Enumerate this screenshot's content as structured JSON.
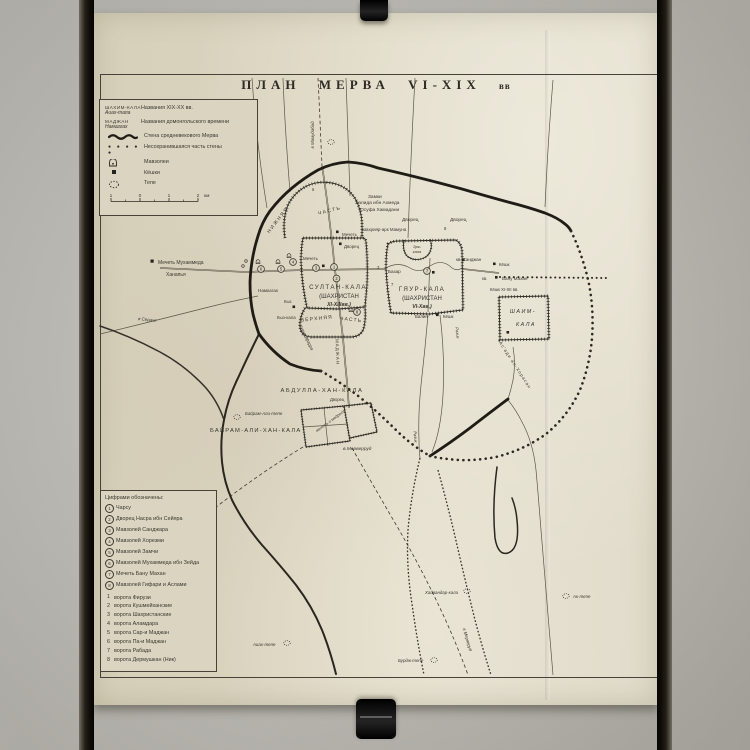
{
  "title": {
    "main": "ПЛАН  МЕРВА  VI-XIX",
    "suffix": "вв"
  },
  "colors": {
    "paper": "#dbd5c1",
    "ink": "#2c2922",
    "frame": "#0e0b07",
    "photo_bg": "#c6c4be"
  },
  "legend": {
    "new_name_example_1": "ШАХИМ-КАЛА",
    "new_name_example_2": "Аиах-тапа",
    "new_name_desc": "Названия XIX-XX вв.",
    "old_name_example_1": "МАДЖАН",
    "old_name_example_2": "Намазгах",
    "old_name_desc": "Названия домонгольского времени",
    "wall_desc": "Стена средневекового Мерва",
    "wall_lost_desc": "Несохранившаяся часть стены",
    "mausoleum_desc": "Мавзолеи",
    "koshk_desc": "Кёшки",
    "tepe_desc": "Тепе",
    "dots_symbol": "● ● ● ● ●",
    "scale": {
      "ticks": [
        "1",
        "0",
        "1",
        "2"
      ],
      "unit": "км"
    }
  },
  "numbered_legend": {
    "heading": "Цифрами обозначены:",
    "sites": [
      {
        "n": "1",
        "label": "Чарсу"
      },
      {
        "n": "2",
        "label": "Дворец Насра ибн Сейяра"
      },
      {
        "n": "3",
        "label": "Мавзолей Санджара"
      },
      {
        "n": "4",
        "label": "Мавзолей Хорезми"
      },
      {
        "n": "5",
        "label": "Мавзолей Замчи"
      },
      {
        "n": "6",
        "label": "Мавзолей Мухаммеда ибн Зейда"
      },
      {
        "n": "7",
        "label": "Мечеть Бану Махан"
      },
      {
        "n": "8",
        "label": "Мавзолей Гифари и Аслами"
      }
    ],
    "gates": [
      {
        "n": "1",
        "label": "ворота Фирузи"
      },
      {
        "n": "2",
        "label": "ворота Кушмейханские"
      },
      {
        "n": "3",
        "label": "ворота Шахристанские"
      },
      {
        "n": "4",
        "label": "ворота Аламдара"
      },
      {
        "n": "5",
        "label": "ворота Сар-и Маджан"
      },
      {
        "n": "6",
        "label": "ворота Па-и Маджан"
      },
      {
        "n": "7",
        "label": "ворота Рабада"
      },
      {
        "n": "8",
        "label": "ворота Дермушкан (Ник)"
      }
    ]
  },
  "map": {
    "sites": [
      {
        "n": "1"
      },
      {
        "n": "2"
      },
      {
        "n": "3"
      },
      {
        "n": "4"
      },
      {
        "n": "5"
      },
      {
        "n": "6"
      },
      {
        "n": "7"
      },
      {
        "n": "8"
      }
    ],
    "gate_digits": [
      {
        "n": "6"
      },
      {
        "n": "3"
      },
      {
        "n": "8"
      },
      {
        "n": "7"
      }
    ],
    "labels": [
      {
        "t": "Замки"
      },
      {
        "t": "Халида ибн Ахмеда"
      },
      {
        "t": "Юсуфа Хамадани"
      },
      {
        "t": "Дворец"
      },
      {
        "t": "Шахрияр-арк Мамуна"
      },
      {
        "t": "Мечеть"
      },
      {
        "t": "Дворец"
      },
      {
        "t": "Дворец"
      },
      {
        "t": "НИЖНЯЯ"
      },
      {
        "t": "ЧАСТЬ"
      },
      {
        "t": "Мечеть"
      },
      {
        "t": "СУЛТАН-КАЛА"
      },
      {
        "t": "(ШАХРИСТАН"
      },
      {
        "t": "XI-XIIIвв.)"
      },
      {
        "t": "ВЕРХНЯЯ"
      },
      {
        "t": "ЧАСТЬ"
      },
      {
        "t": "ГЯУР-КАЛА"
      },
      {
        "t": "(ШАХРИСТАН"
      },
      {
        "t": "VI-Xвв.)"
      },
      {
        "t": "Эрк-"
      },
      {
        "t": "кала"
      },
      {
        "t": "Базар"
      },
      {
        "t": "кв. Санджан"
      },
      {
        "t": "Кёшк"
      },
      {
        "t": "кв."
      },
      {
        "t": "Бану Махан"
      },
      {
        "t": "Кёшк XI-XII вв."
      },
      {
        "t": "ШАИМ-"
      },
      {
        "t": "КАЛА"
      },
      {
        "t": "Балин"
      },
      {
        "t": "Кёшк"
      },
      {
        "t": "Мечеть Мухаммеда"
      },
      {
        "t": "Ханапья"
      },
      {
        "t": "в Серахс"
      },
      {
        "t": "Намазгах"
      },
      {
        "t": "Кыз"
      },
      {
        "t": "Кыз-кала"
      },
      {
        "t": "Хурмузфарра"
      },
      {
        "t": "МАДЖАН"
      },
      {
        "t": "Разик"
      },
      {
        "t": "Разик"
      },
      {
        "t": "Ас'ади ал-Хорасан"
      },
      {
        "t": "АБДУЛЛА-ХАН-КАЛА"
      },
      {
        "t": "Дворец"
      },
      {
        "t": "мечеть и медресе"
      },
      {
        "t": "Байрам-Али-тепе"
      },
      {
        "t": "БАЙРАМ-АЛИ-ХАН-КАЛА"
      },
      {
        "t": "в.Мерверруд"
      },
      {
        "t": "в Мерверуд"
      },
      {
        "t": "Хайвандар-кала"
      },
      {
        "t": "Ак-тепе"
      },
      {
        "t": "Бурдж-тепе"
      },
      {
        "t": "Аиах-тепе"
      },
      {
        "t": "в Мамудабад"
      }
    ]
  }
}
